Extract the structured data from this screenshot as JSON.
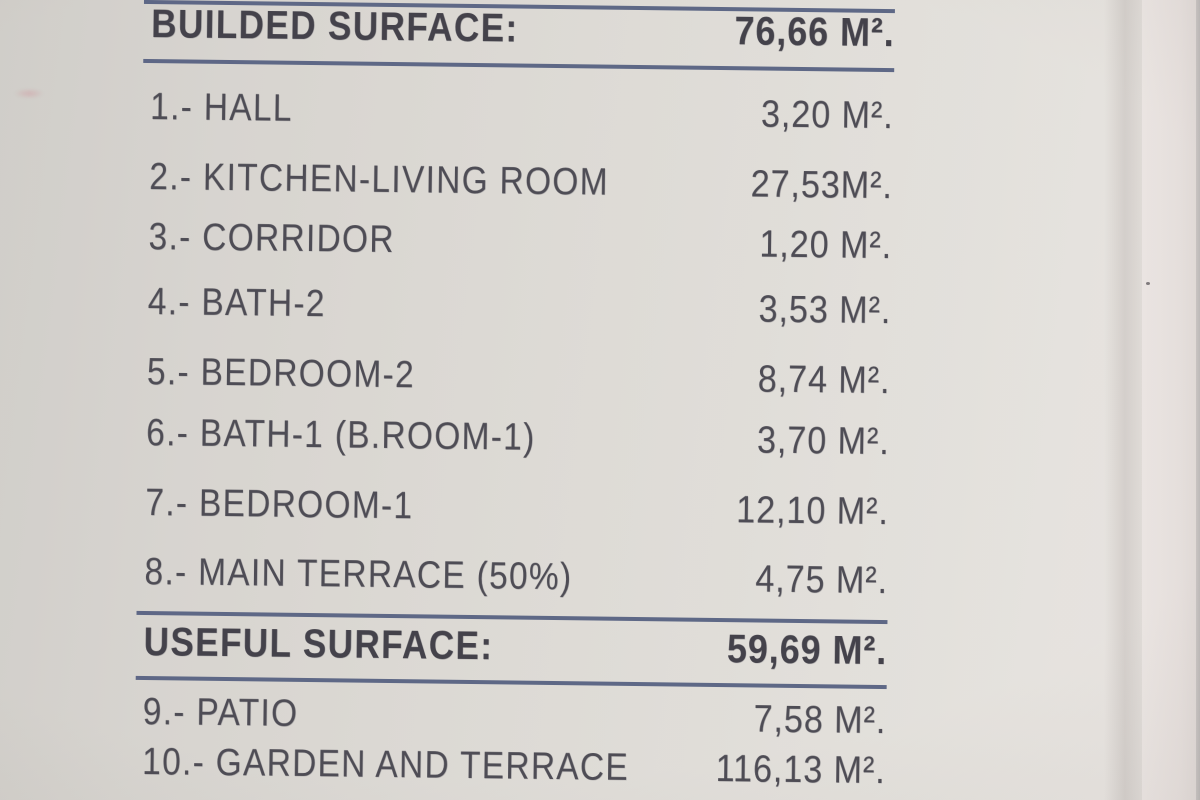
{
  "document": {
    "title": "Dwelling surface schedule",
    "colors": {
      "rule_blue": "#4a5679",
      "ink": "#45434c",
      "paper": "#dad7d2"
    },
    "sections": [
      {
        "header": {
          "label": "BUILDED SURFACE:",
          "value": "76,66 M²."
        },
        "rows": [
          {
            "label": "1.- HALL",
            "value": "3,20 M²."
          },
          {
            "label": "2.- KITCHEN-LIVING ROOM",
            "value": "27,53M²."
          },
          {
            "label": "3.- CORRIDOR",
            "value": "1,20 M²."
          },
          {
            "label": "4.- BATH-2",
            "value": "3,53 M²."
          },
          {
            "label": "5.- BEDROOM-2",
            "value": "8,74 M²."
          },
          {
            "label": "6.- BATH-1 (B.ROOM-1)",
            "value": "3,70 M²."
          },
          {
            "label": "7.- BEDROOM-1",
            "value": "12,10 M²."
          },
          {
            "label": "8.- MAIN TERRACE (50%)",
            "value": "4,75 M²."
          }
        ]
      },
      {
        "header": {
          "label": "USEFUL SURFACE:",
          "value": "59,69 M²."
        },
        "rows": [
          {
            "label": "9.- PATIO",
            "value": "7,58 M²."
          },
          {
            "label": "10.- GARDEN AND TERRACE",
            "value": "116,13 M²."
          }
        ]
      }
    ]
  }
}
